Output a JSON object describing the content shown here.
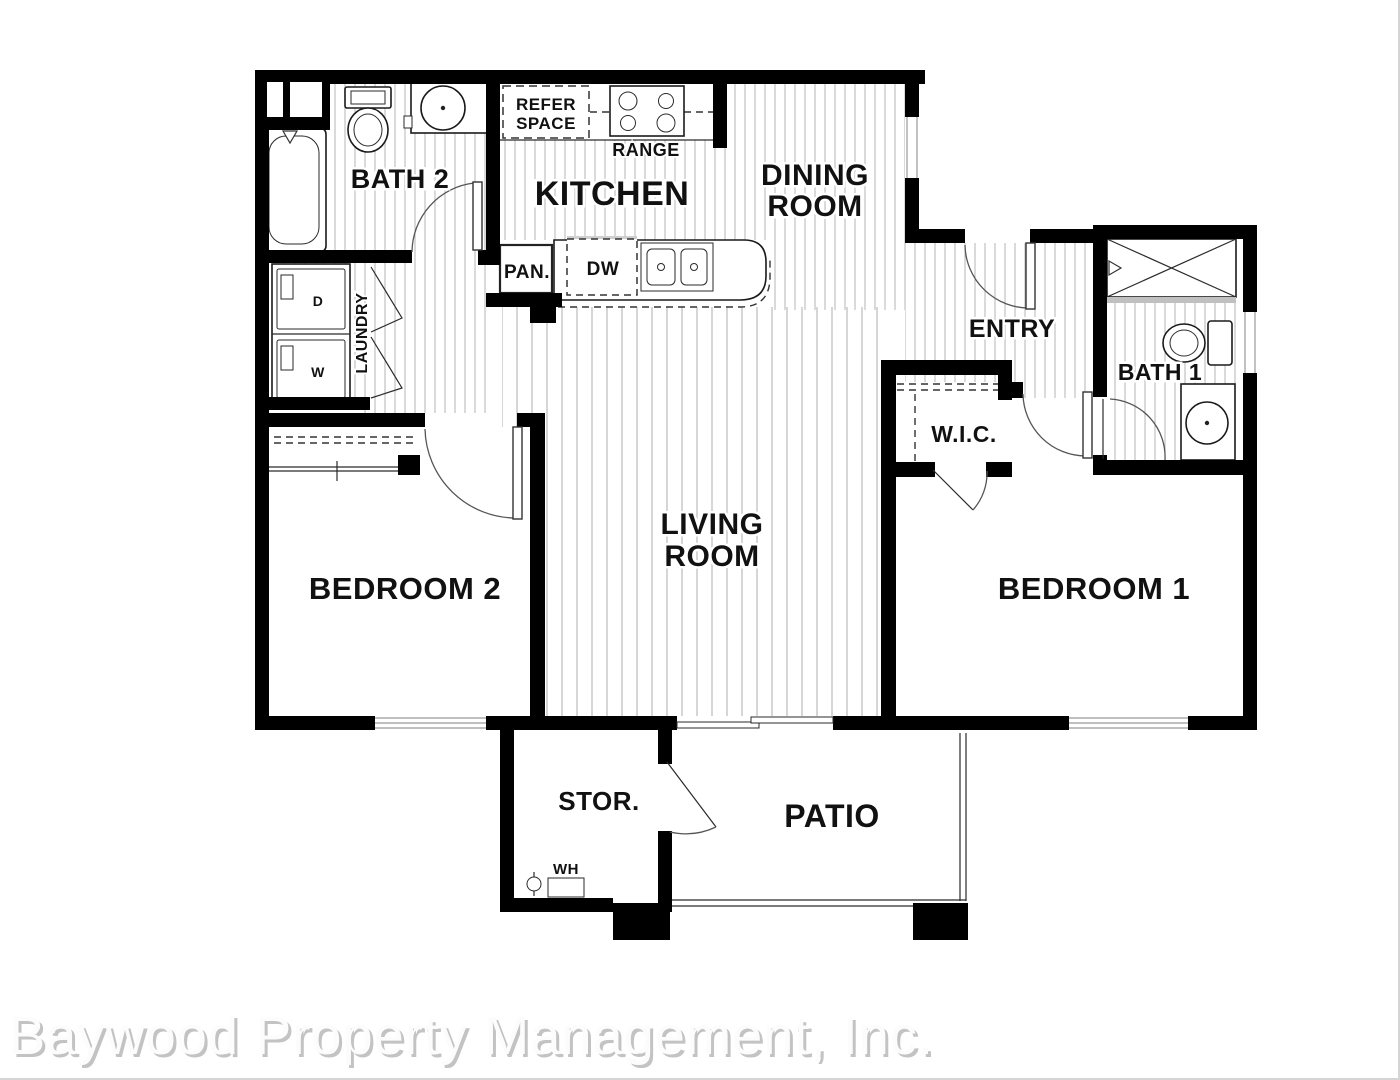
{
  "watermark": "Baywood Property Management, Inc.",
  "colors": {
    "wall": "#000000",
    "hatch_floor": "#b4b4b4",
    "label_text": "#111111",
    "watermark_shadow": "#c3c3c3",
    "watermark_fill": "#fcfcfc"
  },
  "rooms": {
    "bath2": "BATH 2",
    "kitchen": "KITCHEN",
    "dining_line1": "DINING",
    "dining_line2": "ROOM",
    "entry": "ENTRY",
    "bath1": "BATH 1",
    "wic": "W.I.C.",
    "living_line1": "LIVING",
    "living_line2": "ROOM",
    "bedroom2": "BEDROOM 2",
    "bedroom1": "BEDROOM 1",
    "storage": "STOR.",
    "patio": "PATIO",
    "laundry": "LAUNDRY"
  },
  "fixtures": {
    "refer_line1": "REFER",
    "refer_line2": "SPACE",
    "range": "RANGE",
    "pantry": "PAN.",
    "dishwasher": "DW",
    "water_heater": "WH",
    "washer": "W",
    "dryer": "D"
  }
}
